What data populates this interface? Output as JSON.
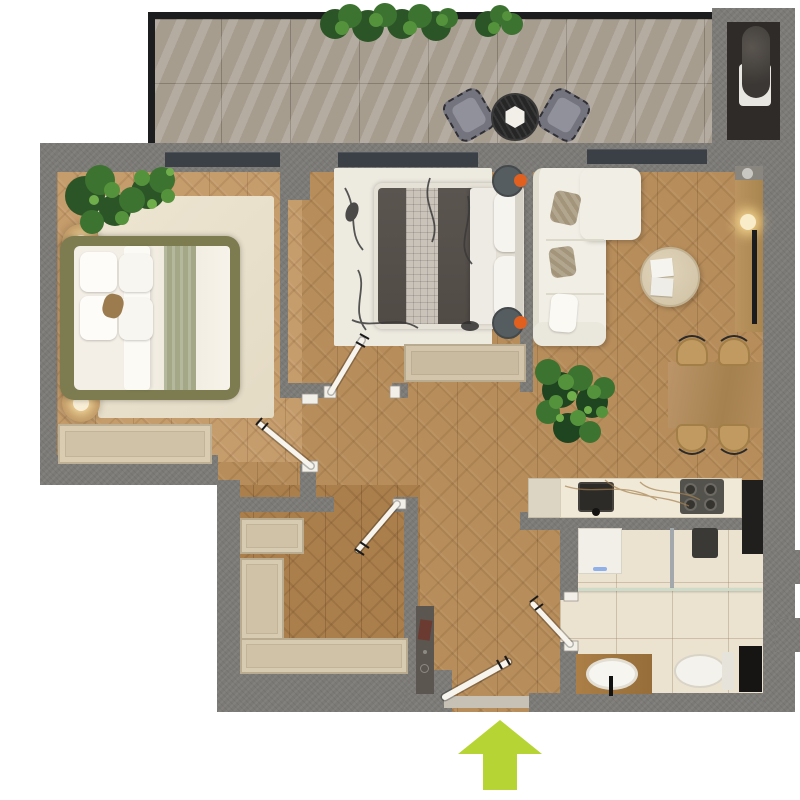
{
  "document": {
    "kind": "apartment-floor-plan-render",
    "view": "top-down",
    "visible_text_labels": [],
    "entrance_indicator": {
      "shape": "arrow",
      "direction": "up",
      "color": "#b6d434"
    }
  },
  "palette": {
    "exterior": "#ffffff",
    "wall_gray": "#7c7a76",
    "railing_dark": "#1c1d1f",
    "window_band": "#3a4046",
    "wood_floor": "#b78d5b",
    "wood_floor_light": "#c59c6b",
    "wood_floor_hall": "#aa7f4c",
    "balcony_tile": "#a79d8f",
    "bathroom_tile": "#ebe2cf",
    "rug_cream": "#e9e1cc",
    "rug_abstract": "#edeae0",
    "bed1_frame_olive": "#7d7c50",
    "bed2_duvet_gray": "#56504b",
    "sofa_cream": "#f1eee5",
    "accent_orange": "#e2601f",
    "counter_marble": "#f0e9d8",
    "plant_green": "#3c7330",
    "arrow_green": "#b6d434"
  },
  "rooms": [
    {
      "name": "balcony",
      "floor": "large gray tiles with sun streaks",
      "items": [
        "hanging planter greenery on railing",
        "round black bistro table with white hex plate",
        "two gray fringed cushion chairs",
        "utility niche with water heater"
      ]
    },
    {
      "name": "bedroom-1",
      "floor": "light herringbone wood",
      "items": [
        "olive-frame double bed with white duvet and sage runner",
        "four white pillows",
        "tan accent cushion",
        "two round nightstands with lit lamps",
        "cream area rug",
        "beige dresser bench",
        "corner plants"
      ]
    },
    {
      "name": "bedroom-2",
      "floor": "herringbone wood",
      "items": [
        "white-frame double bed with dark gray duvet and plaid runner",
        "two white pillows",
        "abstract white rug with black squiggles",
        "two round charcoal side tables with orange accents",
        "beige storage bench"
      ]
    },
    {
      "name": "living-dining",
      "floor": "herringbone wood",
      "items": [
        "cream L-shaped sofa with throw pillows",
        "round light-wood coffee table with magazines",
        "wood media sideboard with lamp and TV",
        "wall shelf with dish",
        "rectangular wood dining table",
        "four tan dining chairs",
        "large potted plant"
      ]
    },
    {
      "name": "kitchen",
      "floor": "herringbone wood",
      "items": [
        "marble countertop",
        "dark square sink with faucet",
        "four-burner cooktop",
        "beige base cabinet",
        "tall dark appliance column"
      ]
    },
    {
      "name": "bathroom",
      "floor": "beige ceramic tiles",
      "items": [
        "washing machine",
        "walk-in shower with glass screen and rain head",
        "wood vanity with oval basin and black faucet",
        "toilet",
        "dark utility niche"
      ]
    },
    {
      "name": "hallway",
      "floor": "herringbone wood",
      "items": [
        "built-in closet niche",
        "tall wardrobe",
        "long low wardrobe"
      ]
    },
    {
      "name": "entry",
      "floor": "herringbone wood",
      "items": [
        "narrow dark console with book and tray",
        "front door threshold",
        "green entrance arrow outside"
      ]
    }
  ],
  "doors": [
    {
      "name": "bedroom-1-door",
      "state": "open"
    },
    {
      "name": "bedroom-2-door",
      "state": "open"
    },
    {
      "name": "hallway-door",
      "state": "open"
    },
    {
      "name": "bathroom-door",
      "state": "open"
    },
    {
      "name": "front-door",
      "state": "open"
    }
  ]
}
